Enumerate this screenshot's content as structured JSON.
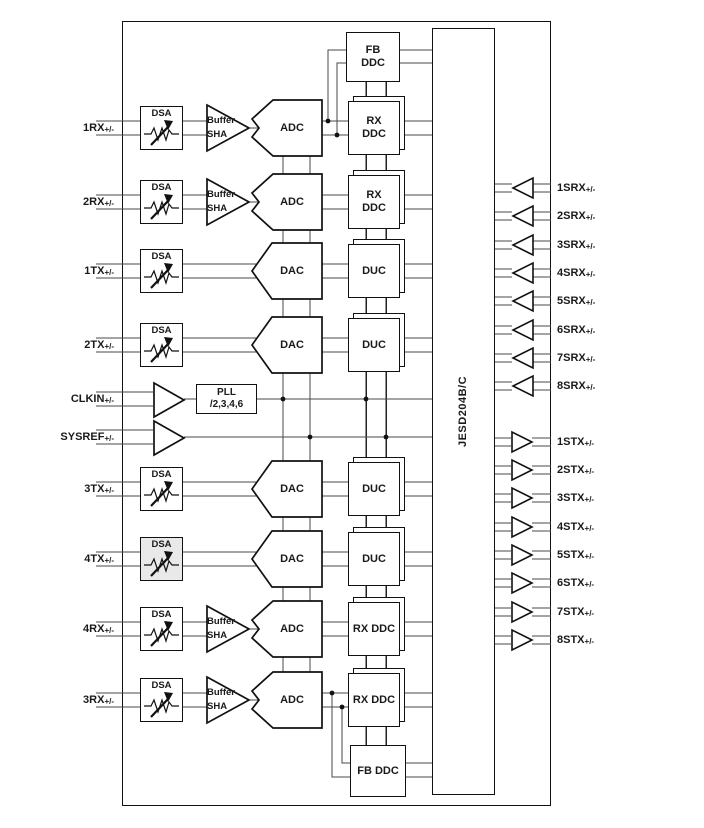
{
  "colors": {
    "wire": "#4a4a4a",
    "shape": "#111111",
    "shaded_dsa": "#e9e9e9",
    "background": "#ffffff"
  },
  "jesd": {
    "label": "JESD204B/C"
  },
  "pll": {
    "lines": [
      "PLL",
      "/2,3,4,6"
    ]
  },
  "clock_port": {
    "base": "CLKIN",
    "suffix": "+/-"
  },
  "sysref_port": {
    "base": "SYSREF",
    "suffix": "+/-"
  },
  "fb_top": {
    "lines": [
      "FB",
      "DDC"
    ]
  },
  "fb_bottom": {
    "lines": [
      "FB DDC"
    ]
  },
  "channels": [
    {
      "port": {
        "base": "1RX",
        "suffix": "+/-"
      },
      "dsa": "DSA",
      "buffer_lines": [
        "Buffer",
        "SHA"
      ],
      "converter": "ADC",
      "block_lines": [
        "RX",
        "DDC"
      ]
    },
    {
      "port": {
        "base": "2RX",
        "suffix": "+/-"
      },
      "dsa": "DSA",
      "buffer_lines": [
        "Buffer",
        "SHA"
      ],
      "converter": "ADC",
      "block_lines": [
        "RX",
        "DDC"
      ]
    },
    {
      "port": {
        "base": "1TX",
        "suffix": "+/-"
      },
      "dsa": "DSA",
      "converter": "DAC",
      "block_lines": [
        "DUC"
      ]
    },
    {
      "port": {
        "base": "2TX",
        "suffix": "+/-"
      },
      "dsa": "DSA",
      "converter": "DAC",
      "block_lines": [
        "DUC"
      ]
    },
    {
      "port": {
        "base": "3TX",
        "suffix": "+/-"
      },
      "dsa": "DSA",
      "converter": "DAC",
      "block_lines": [
        "DUC"
      ]
    },
    {
      "port": {
        "base": "4TX",
        "suffix": "+/-"
      },
      "dsa": "DSA",
      "converter": "DAC",
      "block_lines": [
        "DUC"
      ],
      "shaded": true
    },
    {
      "port": {
        "base": "4RX",
        "suffix": "+/-"
      },
      "dsa": "DSA",
      "buffer_lines": [
        "Buffer",
        "SHA"
      ],
      "converter": "ADC",
      "block_lines": [
        "RX DDC"
      ]
    },
    {
      "port": {
        "base": "3RX",
        "suffix": "+/-"
      },
      "dsa": "DSA",
      "buffer_lines": [
        "Buffer",
        "SHA"
      ],
      "converter": "ADC",
      "block_lines": [
        "RX DDC"
      ]
    }
  ],
  "srx_ports": [
    {
      "base": "1SRX",
      "suffix": "+/-"
    },
    {
      "base": "2SRX",
      "suffix": "+/-"
    },
    {
      "base": "3SRX",
      "suffix": "+/-"
    },
    {
      "base": "4SRX",
      "suffix": "+/-"
    },
    {
      "base": "5SRX",
      "suffix": "+/-"
    },
    {
      "base": "6SRX",
      "suffix": "+/-"
    },
    {
      "base": "7SRX",
      "suffix": "+/-"
    },
    {
      "base": "8SRX",
      "suffix": "+/-"
    }
  ],
  "stx_ports": [
    {
      "base": "1STX",
      "suffix": "+/-"
    },
    {
      "base": "2STX",
      "suffix": "+/-"
    },
    {
      "base": "3STX",
      "suffix": "+/-"
    },
    {
      "base": "4STX",
      "suffix": "+/-"
    },
    {
      "base": "5STX",
      "suffix": "+/-"
    },
    {
      "base": "6STX",
      "suffix": "+/-"
    },
    {
      "base": "7STX",
      "suffix": "+/-"
    },
    {
      "base": "8STX",
      "suffix": "+/-"
    }
  ]
}
